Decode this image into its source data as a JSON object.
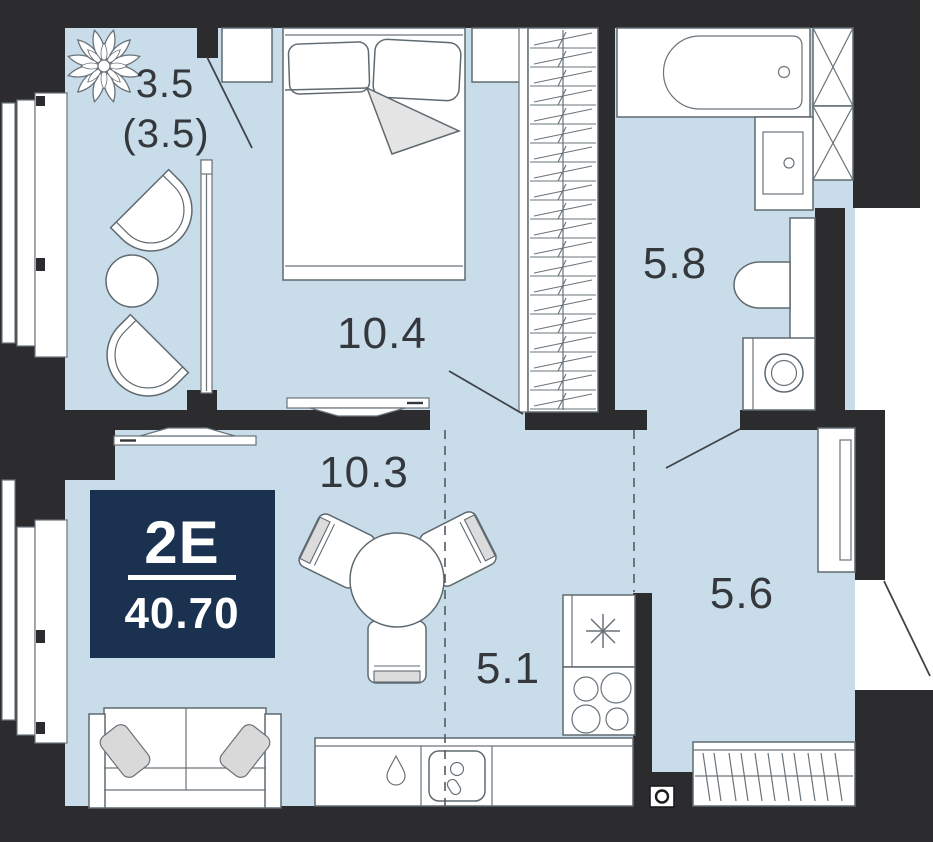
{
  "badge": {
    "unit_type": "2Е",
    "total_area": "40.70"
  },
  "rooms": {
    "balcony": {
      "area": "3.5",
      "area_reduced": "(3.5)"
    },
    "bedroom": {
      "area": "10.4"
    },
    "living_room": {
      "area": "10.3"
    },
    "kitchen": {
      "area": "5.1"
    },
    "bathroom": {
      "area": "5.8"
    },
    "hallway": {
      "area": "5.6"
    }
  },
  "colors": {
    "floor": "#c8dcea",
    "wall": "#2c2c2e",
    "outline": "#5f6a70",
    "badge_bg": "#1b3150",
    "badge_text": "#ffffff",
    "label_text": "#34383c",
    "soft_gray": "#dcdcdc"
  }
}
